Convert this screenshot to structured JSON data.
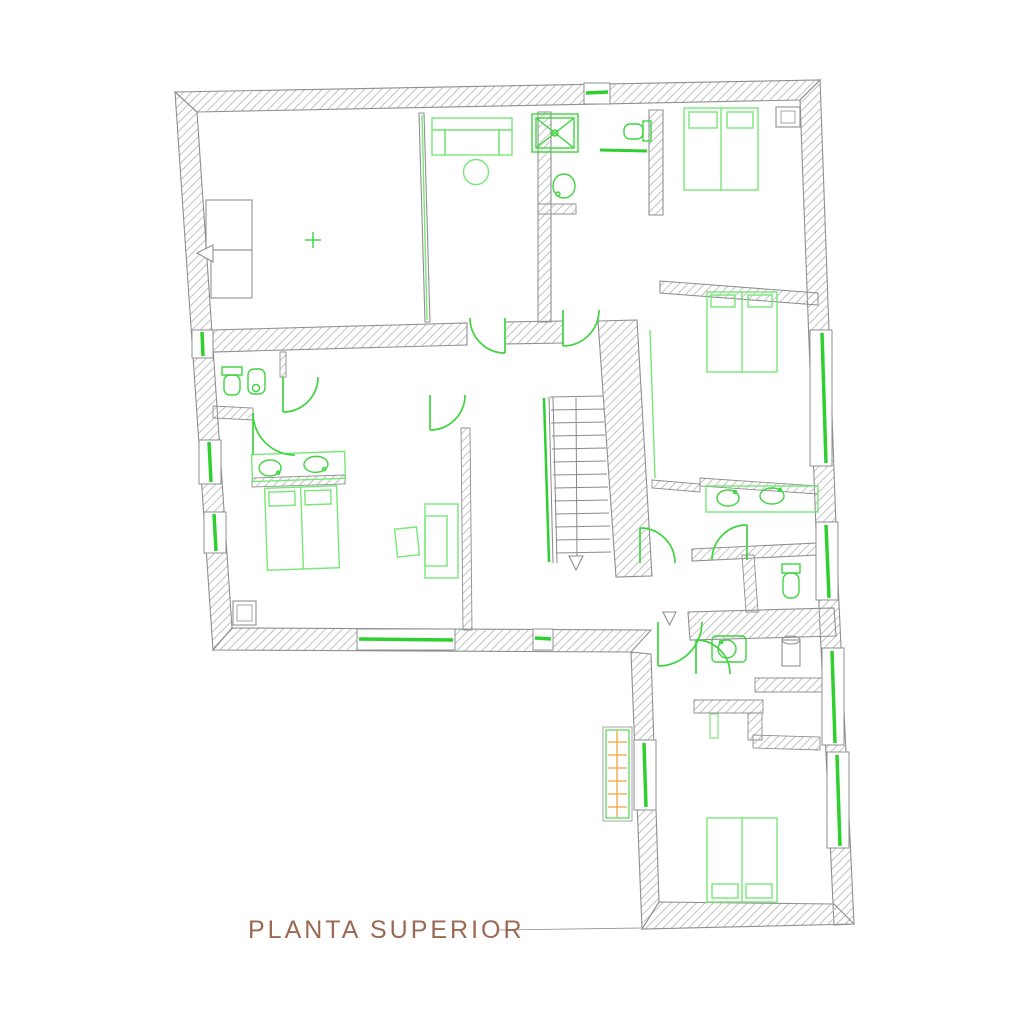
{
  "title": {
    "text": "PLANTA SUPERIOR"
  },
  "colors": {
    "background": "#ffffff",
    "wall_outline": "#8f8f8f",
    "wall_hatch": "#c2c2c2",
    "furniture_green": "#77e877",
    "fixture_green": "#3fd43f",
    "window_green": "#2fcf2f",
    "accent_orange": "#f2a23c",
    "title_brown": "#9a6a52"
  },
  "plan": {
    "type": "architectural-floor-plan",
    "floor_label": "PLANTA SUPERIOR",
    "symbols": [
      "double-bed",
      "sofa",
      "round-table",
      "wardrobe",
      "side-table",
      "shower",
      "toilet",
      "bidet",
      "washbasin",
      "double-washbasin-vanity",
      "staircase-down",
      "door-swing",
      "window",
      "ventilation-grille",
      "center-cross-marker",
      "entry-arrow"
    ]
  }
}
